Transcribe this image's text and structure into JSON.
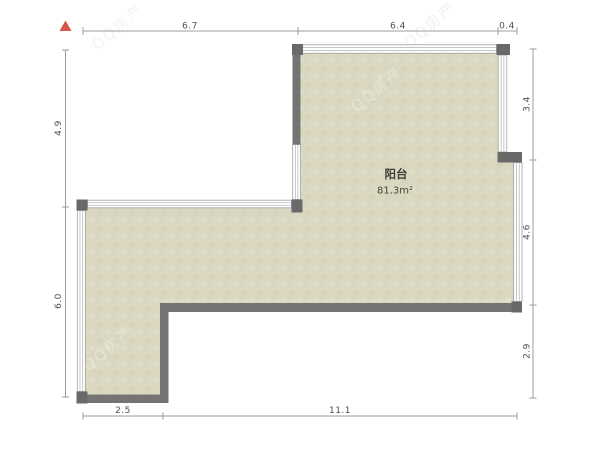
{
  "compass": {
    "symbol": "▲"
  },
  "dims": {
    "top": [
      "6.7",
      "6.4",
      "0.4"
    ],
    "left": [
      "4.9",
      "6.0"
    ],
    "right": [
      "3.4",
      "4.6",
      "2.9"
    ],
    "bottom": [
      "2.5",
      "11.1"
    ]
  },
  "room": {
    "name": "阳台",
    "area": "81.3m²"
  },
  "watermark": {
    "text": "QQ房产"
  },
  "colors": {
    "floor_fill": "#dbd8c2",
    "floor_texture_dark": "#d2cfb8",
    "floor_texture_light": "#e5e2cf",
    "wall": "#767472",
    "wall_corner": "#696969",
    "window_line": "#b0b0b0",
    "dimension_line": "#9c9c9c",
    "dimension_text": "#4f4f4f",
    "north_arrow": "#d9544d",
    "room_text": "#3c3c33",
    "watermark_text": "#e7e5da"
  }
}
